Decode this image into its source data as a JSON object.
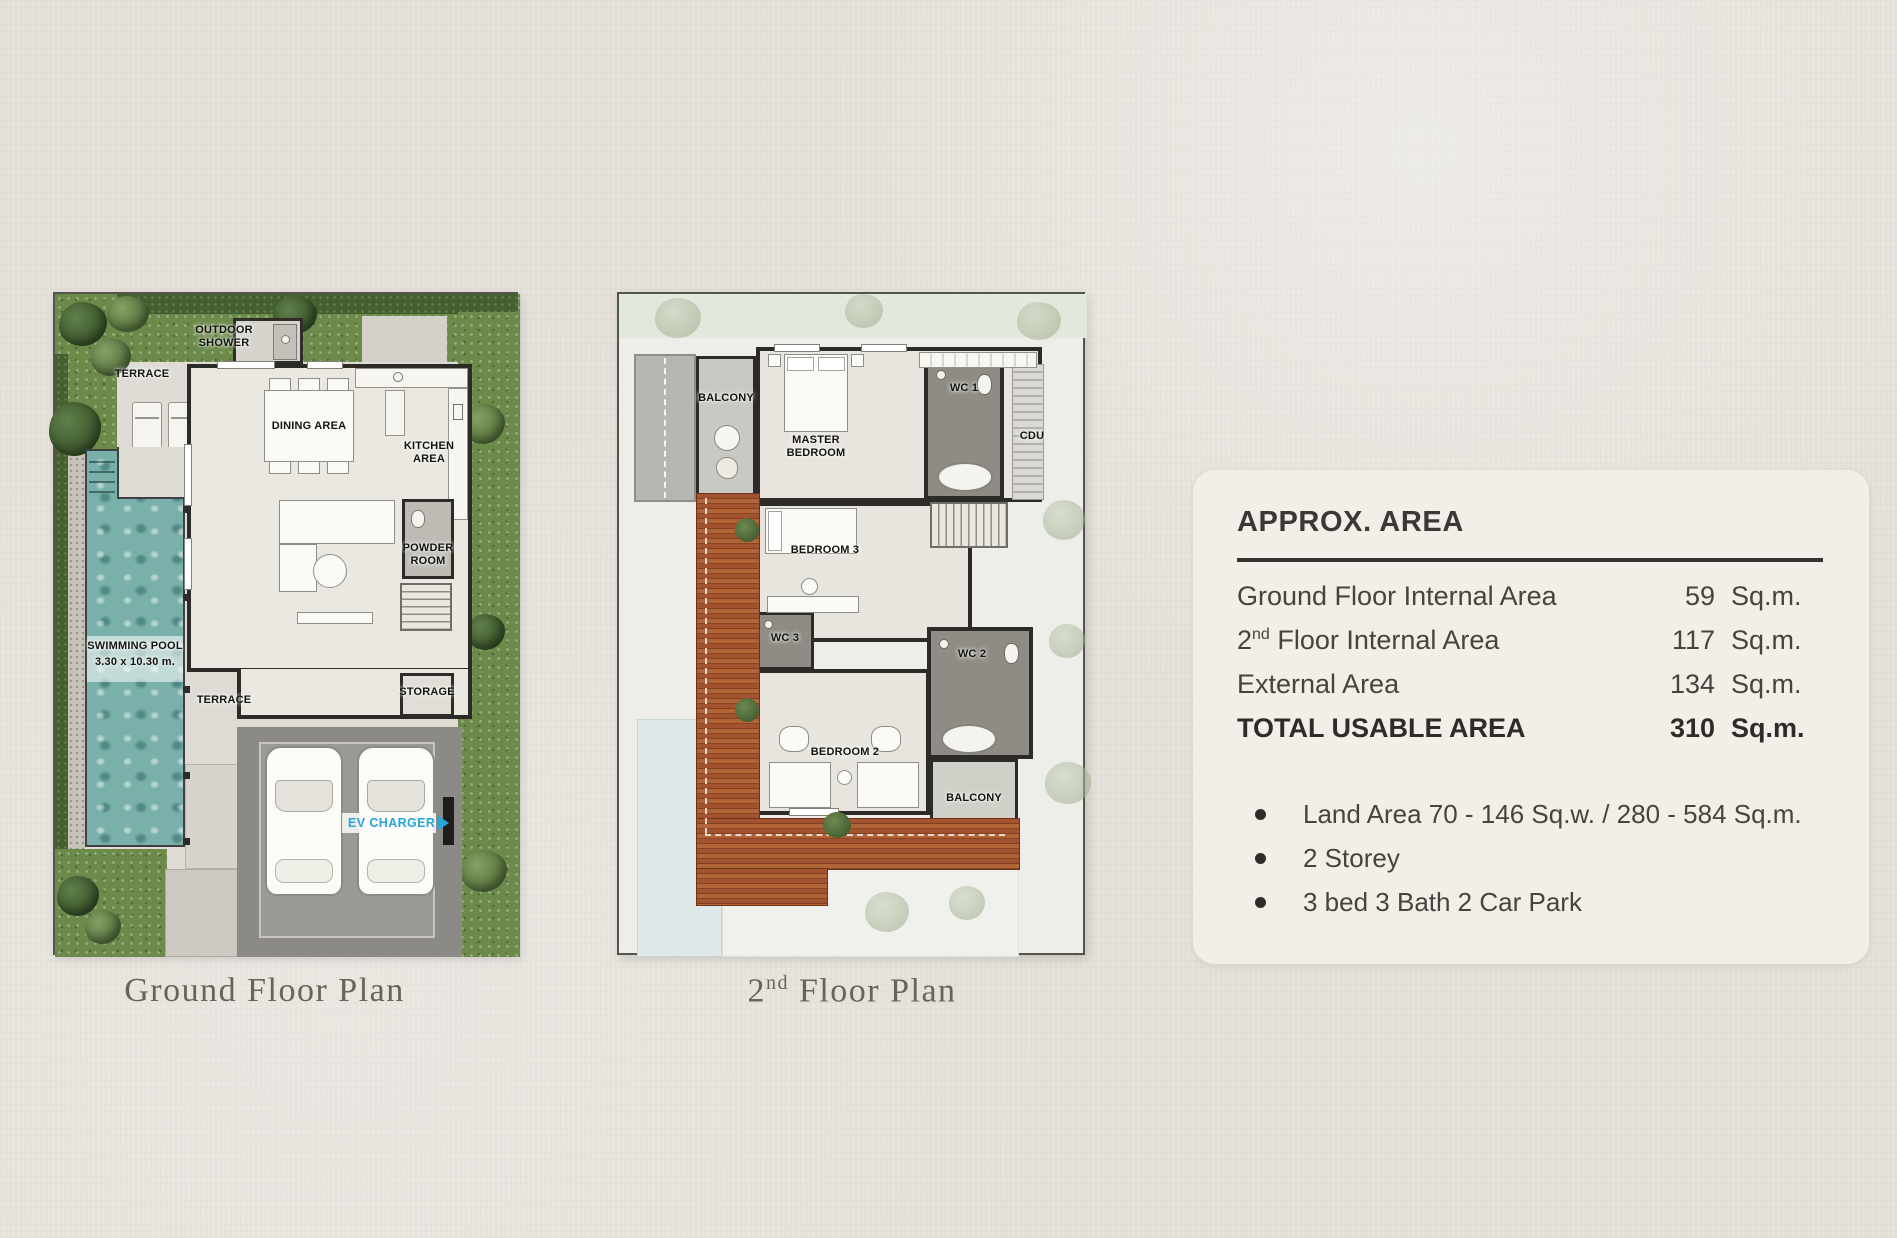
{
  "ground_floor": {
    "caption": "Ground Floor Plan",
    "labels": {
      "outdoor_shower": "OUTDOOR\nSHOWER",
      "terrace_top": "TERRACE",
      "dining_area": "DINING AREA",
      "kitchen_area": "KITCHEN\nAREA",
      "powder_room": "POWDER\nROOM",
      "swimming_pool": "SWIMMING POOL",
      "pool_dimensions": "3.30 x 10.30 m.",
      "terrace_mid": "TERRACE",
      "storage": "STORAGE",
      "ev_charger": "EV CHARGER"
    }
  },
  "second_floor": {
    "caption": {
      "num": "2",
      "sup": "nd",
      "rest": " Floor Plan"
    },
    "labels": {
      "balcony_top": "BALCONY",
      "master_bedroom": "MASTER\nBEDROOM",
      "wc1": "WC 1",
      "cdu": "CDU",
      "bedroom3": "BEDROOM 3",
      "wc3": "WC 3",
      "wc2": "WC 2",
      "bedroom2": "BEDROOM 2",
      "balcony_bottom": "BALCONY"
    }
  },
  "area_panel": {
    "title": "APPROX. AREA",
    "rows": [
      {
        "label_pre": "Ground Floor Internal Area",
        "label_sup": "",
        "label_post": "",
        "value": "59",
        "unit": "Sq.m."
      },
      {
        "label_pre": "2",
        "label_sup": "nd",
        "label_post": "  Floor Internal Area",
        "value": "117",
        "unit": "Sq.m."
      },
      {
        "label_pre": "External Area",
        "label_sup": "",
        "label_post": "",
        "value": "134",
        "unit": "Sq.m."
      },
      {
        "label_pre": "TOTAL USABLE AREA",
        "label_sup": "",
        "label_post": "",
        "value": "310",
        "unit": "Sq.m."
      }
    ],
    "bullets": [
      "Land Area 70 - 146 Sq.w. / 280 - 584 Sq.m.",
      "2 Storey",
      "3 bed 3 Bath 2 Car Park"
    ]
  },
  "accent_colors": {
    "ev_blue": "#2aa5d9",
    "pool_teal": "#79b0aa",
    "roof_terracotta": "#a3532f"
  }
}
